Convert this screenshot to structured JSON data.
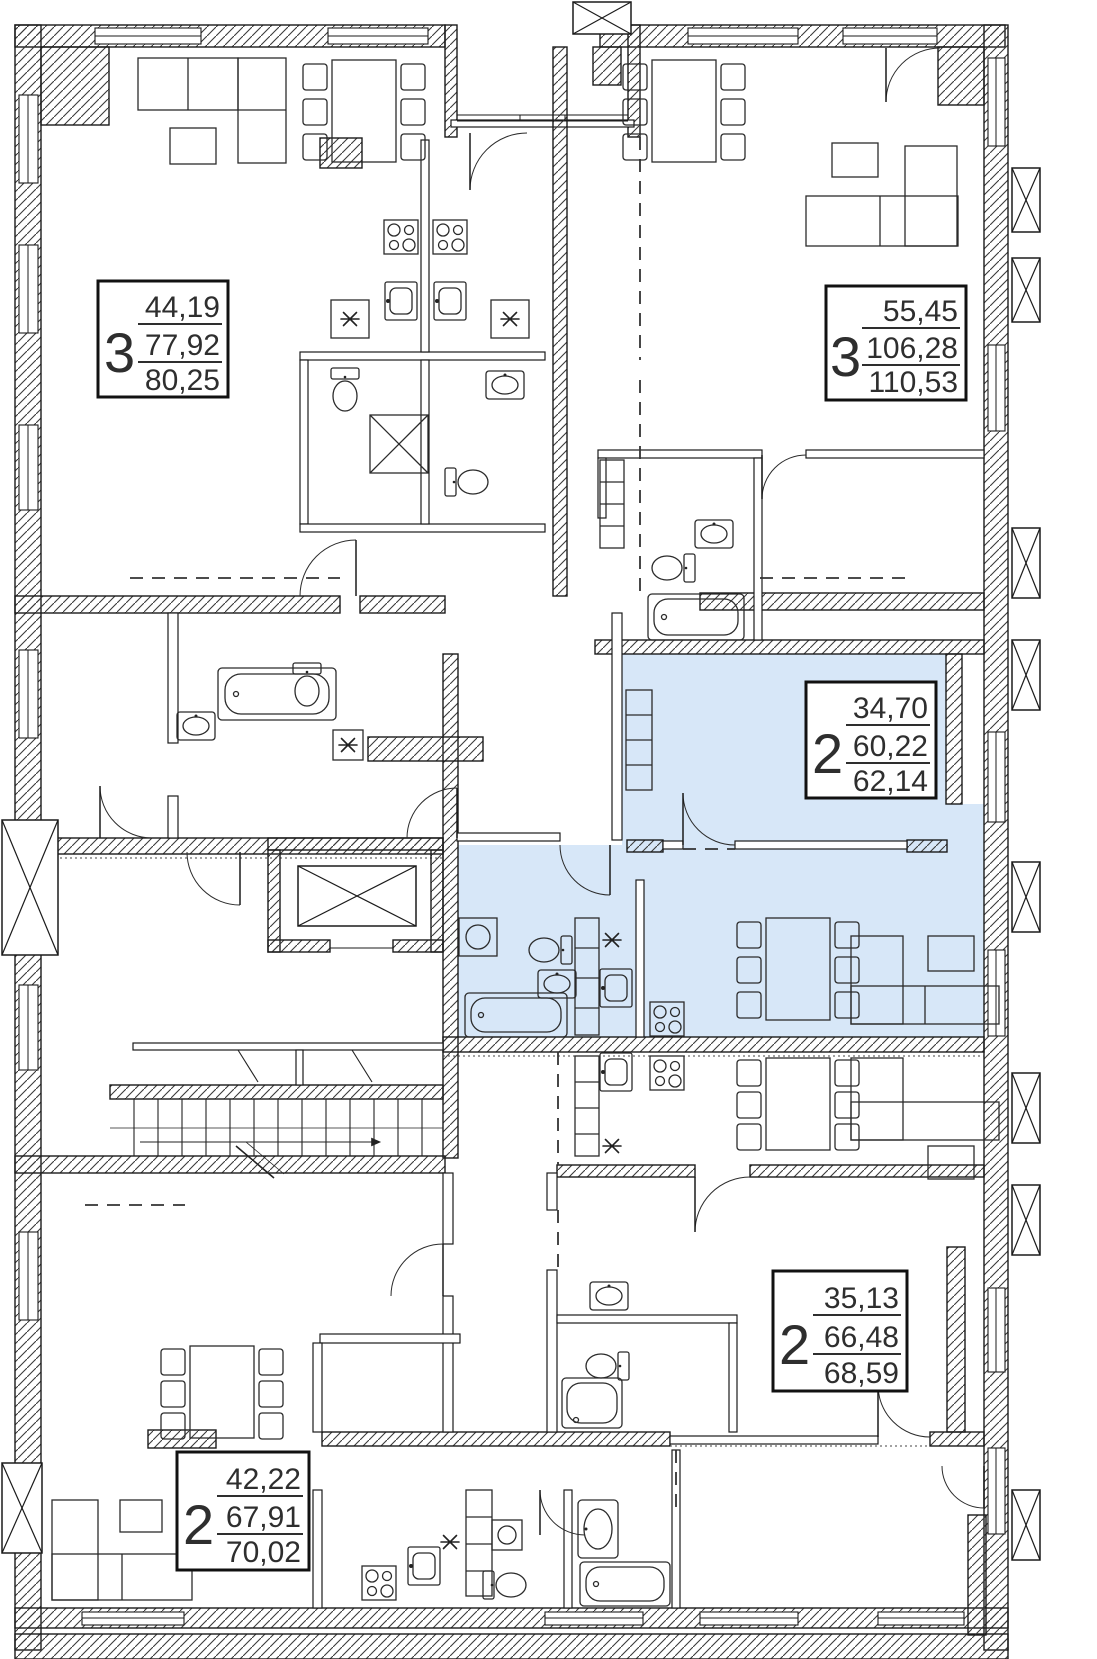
{
  "plan": {
    "highlight_color": "#d7e7f8",
    "line_color": "#1b1b1b",
    "apartments": [
      {
        "rooms": "3",
        "area_living": "44,19",
        "area_apartment": "77,92",
        "area_total": "80,25",
        "highlighted": false
      },
      {
        "rooms": "3",
        "area_living": "55,45",
        "area_apartment": "106,28",
        "area_total": "110,53",
        "highlighted": false
      },
      {
        "rooms": "2",
        "area_living": "34,70",
        "area_apartment": "60,22",
        "area_total": "62,14",
        "highlighted": true
      },
      {
        "rooms": "2",
        "area_living": "35,13",
        "area_apartment": "66,48",
        "area_total": "68,59",
        "highlighted": false
      },
      {
        "rooms": "2",
        "area_living": "42,22",
        "area_apartment": "67,91",
        "area_total": "70,02",
        "highlighted": false
      }
    ]
  }
}
